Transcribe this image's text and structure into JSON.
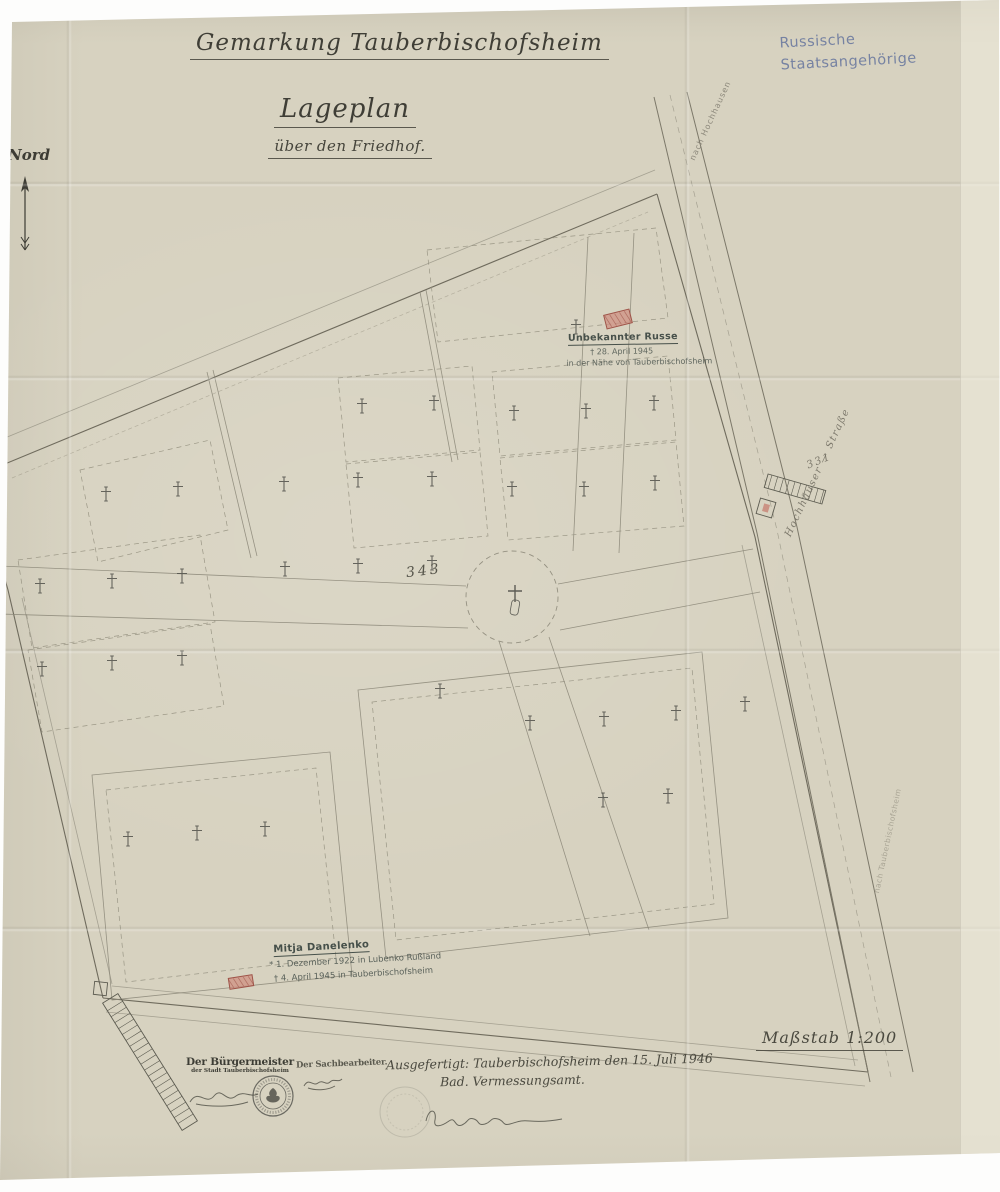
{
  "titles": {
    "region": "Gemarkung Tauberbischofsheim",
    "main": "Lageplan",
    "sub": "über den Friedhof."
  },
  "notes": {
    "russian_line1": "Russische",
    "russian_line2": "Staatsangehörige"
  },
  "compass": {
    "north": "Nord"
  },
  "graves": {
    "unknown": {
      "name": "Unbekannter Russe",
      "died": "† 28. April 1945",
      "place": "in der Nähe von Tauberbischofsheim"
    },
    "danelenko": {
      "name": "Mitja Danelenko",
      "born": "* 1. Dezember 1922 in Lubenko Rußland",
      "died": "† 4. April 1945 in Tauberbischofsheim"
    }
  },
  "parcels": {
    "p343": "343",
    "p331": "331"
  },
  "roads": {
    "street": "Hochhäuser — Straße",
    "to_north": "nach Hochhausen",
    "to_town": "nach Tauberbischofsheim"
  },
  "scale": {
    "label": "Maßstab 1:200"
  },
  "footer": {
    "mayor_line1": "Der Bürgermeister",
    "mayor_line2": "der Stadt Tauberbischofsheim",
    "clerk": "Der Sachbearbeiter.",
    "issued": "Ausgefertigt: Tauberbischofsheim den 15. Juli 1946",
    "office": "Bad. Vermessungsamt."
  },
  "map": {
    "crosses": [
      [
        576,
        327
      ],
      [
        362,
        406
      ],
      [
        434,
        403
      ],
      [
        514,
        413
      ],
      [
        586,
        411
      ],
      [
        654,
        403
      ],
      [
        106,
        494
      ],
      [
        178,
        489
      ],
      [
        284,
        484
      ],
      [
        358,
        480
      ],
      [
        432,
        479
      ],
      [
        512,
        489
      ],
      [
        584,
        489
      ],
      [
        655,
        483
      ],
      [
        40,
        586
      ],
      [
        112,
        581
      ],
      [
        182,
        576
      ],
      [
        285,
        569
      ],
      [
        358,
        566
      ],
      [
        432,
        563
      ],
      [
        42,
        669
      ],
      [
        112,
        663
      ],
      [
        182,
        658
      ],
      [
        440,
        691
      ],
      [
        530,
        723
      ],
      [
        604,
        719
      ],
      [
        676,
        713
      ],
      [
        745,
        704
      ],
      [
        603,
        800
      ],
      [
        668,
        796
      ],
      [
        128,
        839
      ],
      [
        197,
        833
      ],
      [
        265,
        829
      ]
    ],
    "monument": [
      515,
      596
    ],
    "red_graves": [
      {
        "x": 618,
        "y": 319,
        "w": 26,
        "h": 14,
        "angle": -14
      },
      {
        "x": 241,
        "y": 982,
        "w": 24,
        "h": 11,
        "angle": -9
      }
    ],
    "colors": {
      "red_fill": "#cf8b7d",
      "red_stroke": "#9e5348",
      "ink": "#45443c",
      "blue": "#6e7ca0"
    }
  }
}
